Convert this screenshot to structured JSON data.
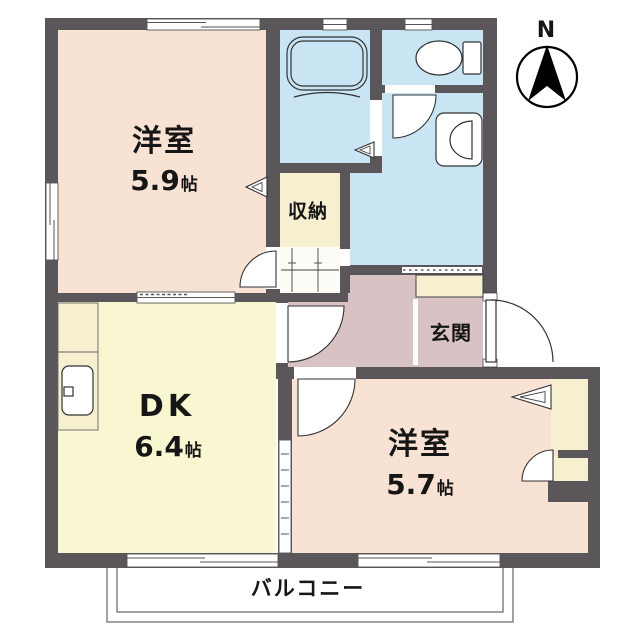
{
  "rooms": {
    "western_room_1": {
      "label": "洋室",
      "size_value": "5.9",
      "size_unit": "帖"
    },
    "dining_kitchen": {
      "label": "DK",
      "size_value": "6.4",
      "size_unit": "帖"
    },
    "western_room_2": {
      "label": "洋室",
      "size_value": "5.7",
      "size_unit": "帖"
    },
    "closet": {
      "label": "収納"
    },
    "entrance": {
      "label": "玄関"
    },
    "balcony": {
      "label": "バルコニー"
    }
  },
  "compass": {
    "label": "N"
  },
  "colors": {
    "wall": "#5b565a",
    "western_room": "#f8e2d3",
    "dining_kitchen": "#f9f6d2",
    "closet": "#f6efd0",
    "wet_area": "#c9e5f4",
    "hallway": "#d9c2c4",
    "hall_strip": "#fdfcf6",
    "balcony_line": "#7a7a7a",
    "fixture_line": "#333333"
  }
}
